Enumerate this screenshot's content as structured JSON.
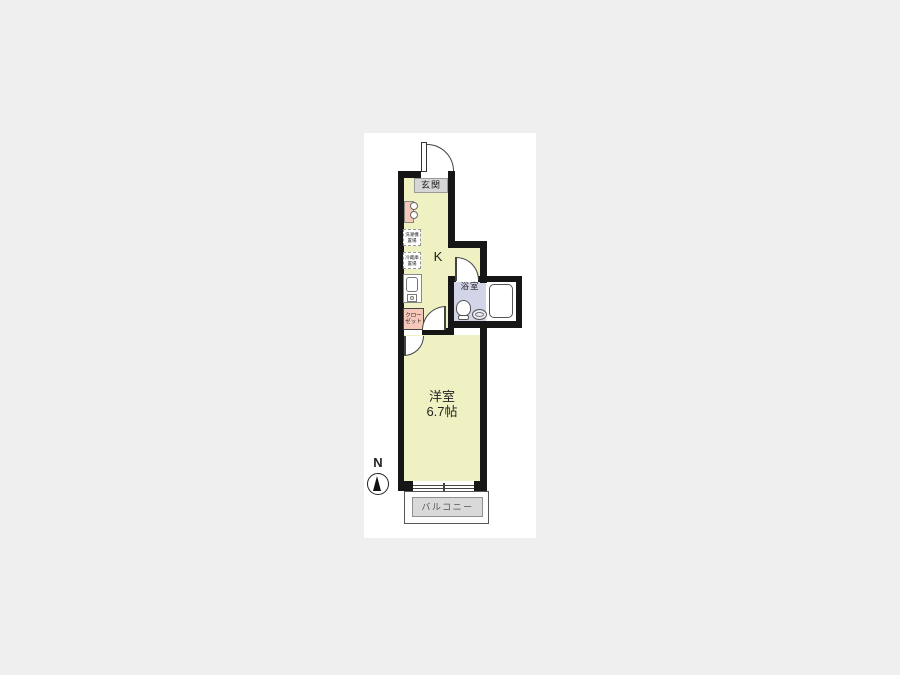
{
  "floorplan": {
    "compass": {
      "north_label": "N"
    },
    "entrance": {
      "label": "玄関"
    },
    "kitchen": {
      "label": "K"
    },
    "bathroom": {
      "label": "浴室"
    },
    "western_room": {
      "label": "洋室",
      "size": "6.7帖"
    },
    "balcony": {
      "label": "バルコニー"
    },
    "closet": {
      "line1": "クロー",
      "line2": "ゼット"
    },
    "washer_space": {
      "line1": "洗濯機",
      "line2": "置場"
    },
    "fridge_space": {
      "line1": "冷蔵庫",
      "line2": "置場"
    },
    "colors": {
      "wall": "#161616",
      "floor": "#f0f1c3",
      "bathroom_floor": "#d2d4e8",
      "accent_pink": "#f5c8ba",
      "entrance_gray": "#d6d6d6",
      "balcony_gray": "#d9d9d9",
      "page_background": "#efefef"
    }
  }
}
